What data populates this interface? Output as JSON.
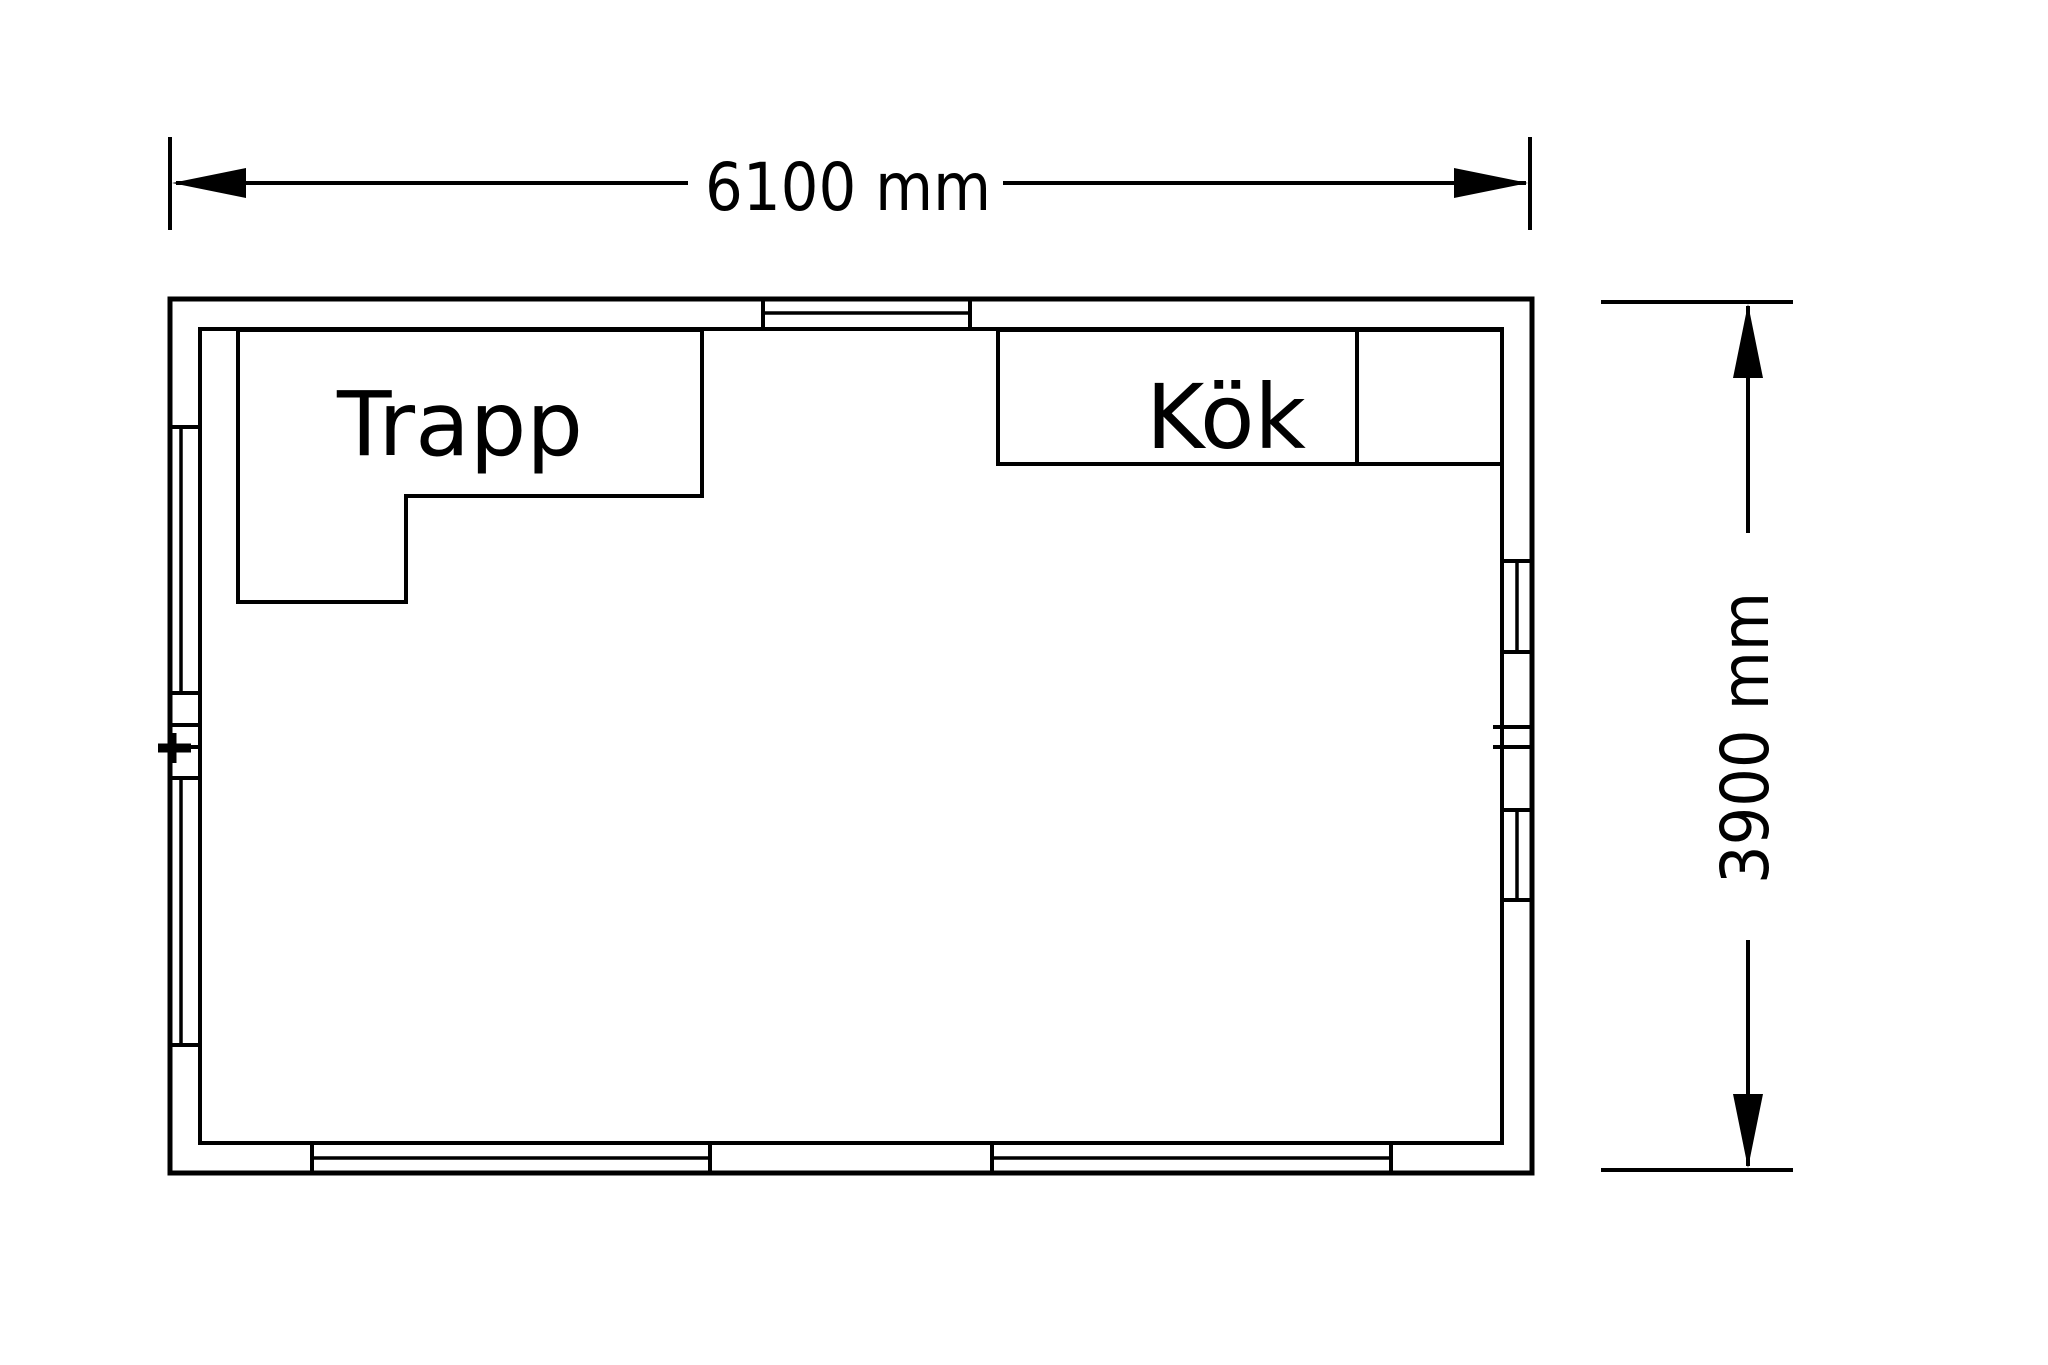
{
  "drawing": {
    "type": "floor-plan",
    "rooms": {
      "trapp": {
        "label": "Trapp"
      },
      "kok": {
        "label": "Kök"
      }
    },
    "dimensions": {
      "width": {
        "label": "6100 mm",
        "value_mm": 6100
      },
      "height": {
        "label": "3900 mm",
        "value_mm": 3900
      }
    },
    "colors": {
      "line": "#000000",
      "background": "#ffffff"
    }
  }
}
